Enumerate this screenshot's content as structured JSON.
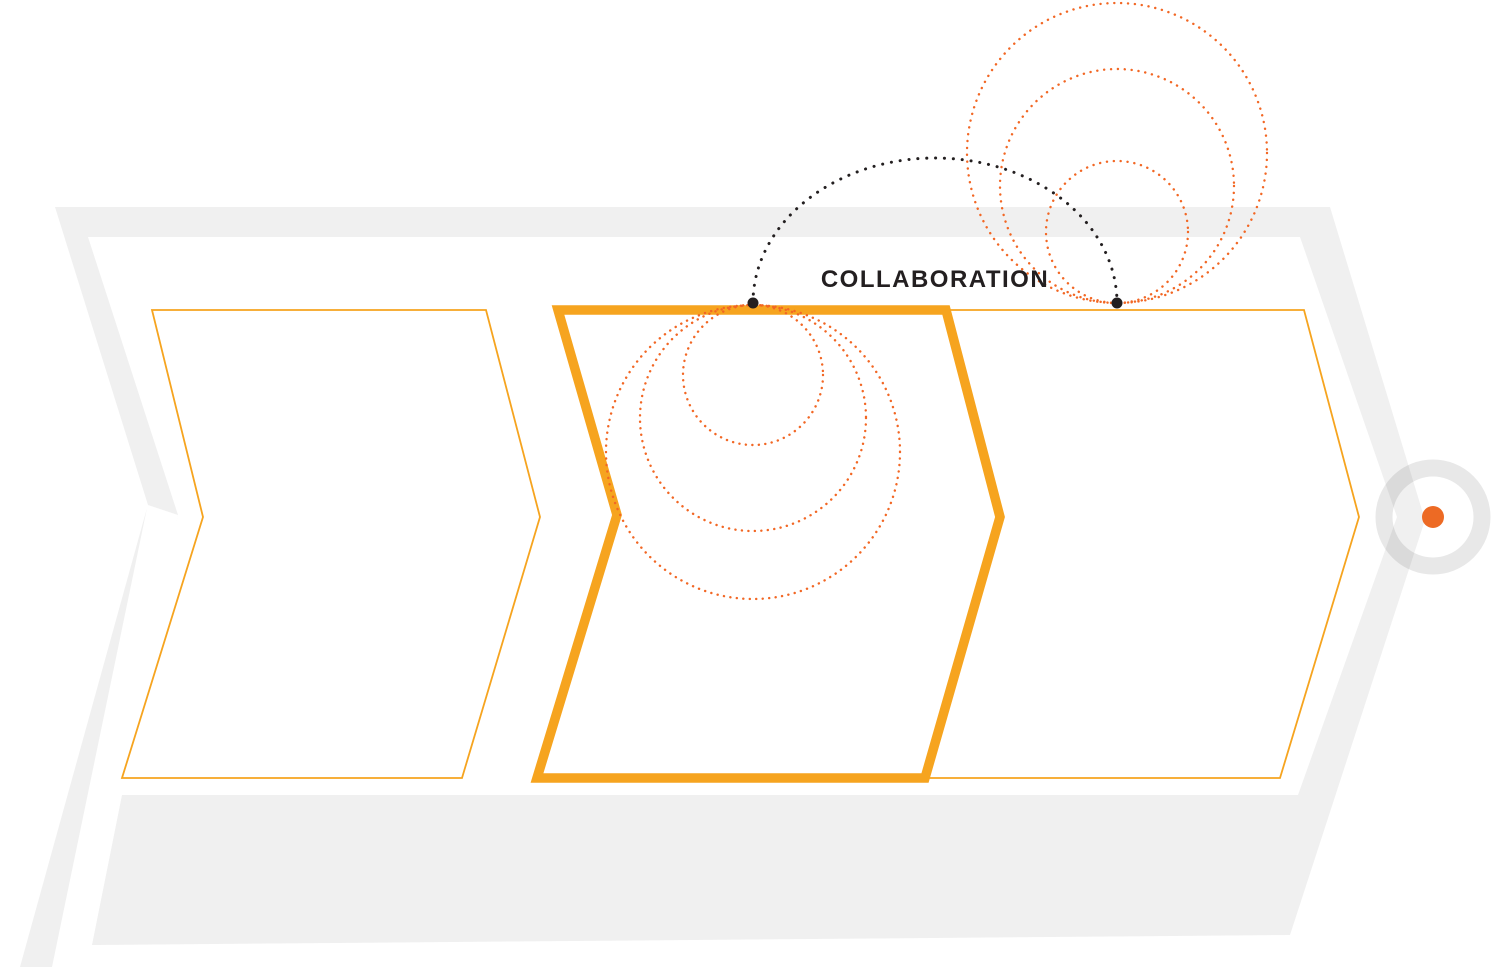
{
  "diagram": {
    "connector_label": "COLLABORATION",
    "steps": [
      {
        "id": "step-1",
        "highlighted": false
      },
      {
        "id": "step-2",
        "highlighted": true
      },
      {
        "id": "step-3",
        "highlighted": false
      }
    ]
  },
  "colors": {
    "band_gray": "#F0F0F0",
    "white": "#FFFFFF",
    "chevron_orange": "#F6A41F",
    "dotted_circle_orange": "#F26724",
    "connector_black": "#231F20",
    "endpoint_dot_orange": "#ED6A24",
    "ring_gray": "rgba(0,0,0,0.09)"
  }
}
